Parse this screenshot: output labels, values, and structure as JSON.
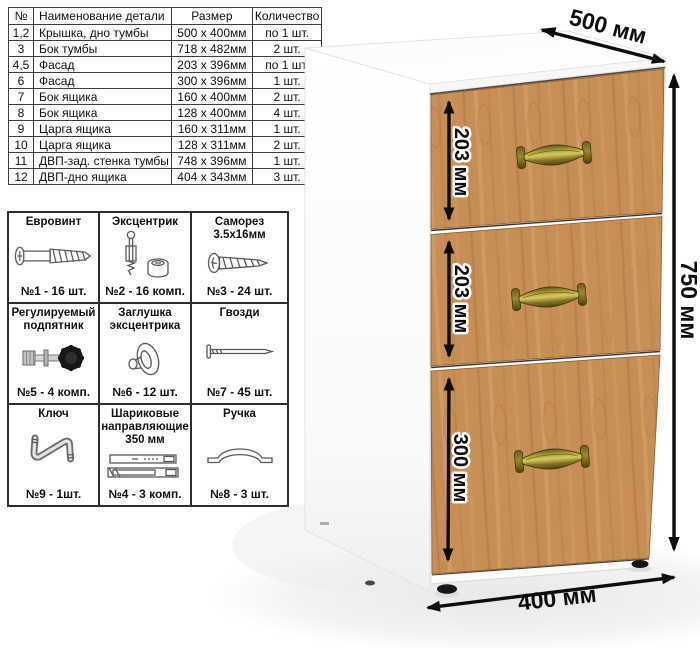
{
  "parts_table": {
    "headers": [
      "№",
      "Наименование детали",
      "Размер",
      "Количество"
    ],
    "rows": [
      [
        "1,2",
        "Крышка, дно тумбы",
        "500 х 400мм",
        "по 1 шт."
      ],
      [
        "3",
        "Бок тумбы",
        "718 х 482мм",
        "2 шт."
      ],
      [
        "4,5",
        "Фасад",
        "203 х 396мм",
        "по 1 шт."
      ],
      [
        "6",
        "Фасад",
        "300 х 396мм",
        "1 шт."
      ],
      [
        "7",
        "Бок ящика",
        "160 х 400мм",
        "2 шт."
      ],
      [
        "8",
        "Бок ящика",
        "128 х 400мм",
        "4 шт."
      ],
      [
        "9",
        "Царга ящика",
        "160 х 311мм",
        "1 шт."
      ],
      [
        "10",
        "Царга ящика",
        "128 х 311мм",
        "2 шт."
      ],
      [
        "11",
        "ДВП-зад. стенка тумбы",
        "748 х 396мм",
        "1 шт."
      ],
      [
        "12",
        "ДВП-дно ящика",
        "404 х 343мм",
        "3 шт."
      ]
    ]
  },
  "hardware": {
    "items": [
      {
        "title": "Евровинт",
        "count": "№1 - 16 шт.",
        "icon": "euro-screw-icon"
      },
      {
        "title": "Эксцентрик",
        "count": "№2 - 16 комп.",
        "icon": "cam-lock-icon"
      },
      {
        "title": "Саморез 3.5х16мм",
        "count": "№3 - 24 шт.",
        "icon": "self-tapping-screw-icon"
      },
      {
        "title": "Регулируемый подпятник",
        "count": "№5 - 4 комп.",
        "icon": "adjustable-foot-icon"
      },
      {
        "title": "Заглушка эксцентрика",
        "count": "№6 - 12 шт.",
        "icon": "cam-cap-icon"
      },
      {
        "title": "Гвозди",
        "count": "№7 - 45 шт.",
        "icon": "nail-icon"
      },
      {
        "title": "Ключ",
        "count": "№9 - 1шт.",
        "icon": "hex-key-icon"
      },
      {
        "title": "Шариковые направляющие 350 мм",
        "count": "№4 - 3 комп.",
        "icon": "ball-bearing-slides-icon"
      },
      {
        "title": "Ручка",
        "count": "№8 - 3 шт.",
        "icon": "handle-icon"
      }
    ]
  },
  "dimensions": {
    "width": "500 мм",
    "height": "750 мм",
    "depth": "400 мм",
    "drawers": [
      "203 мм",
      "203 мм",
      "300 мм"
    ]
  },
  "colors": {
    "wood": "#c78e56",
    "handle_brass": "#8f7f33",
    "arrow": "#0d0d0d",
    "table_border": "#3d3d3d"
  }
}
